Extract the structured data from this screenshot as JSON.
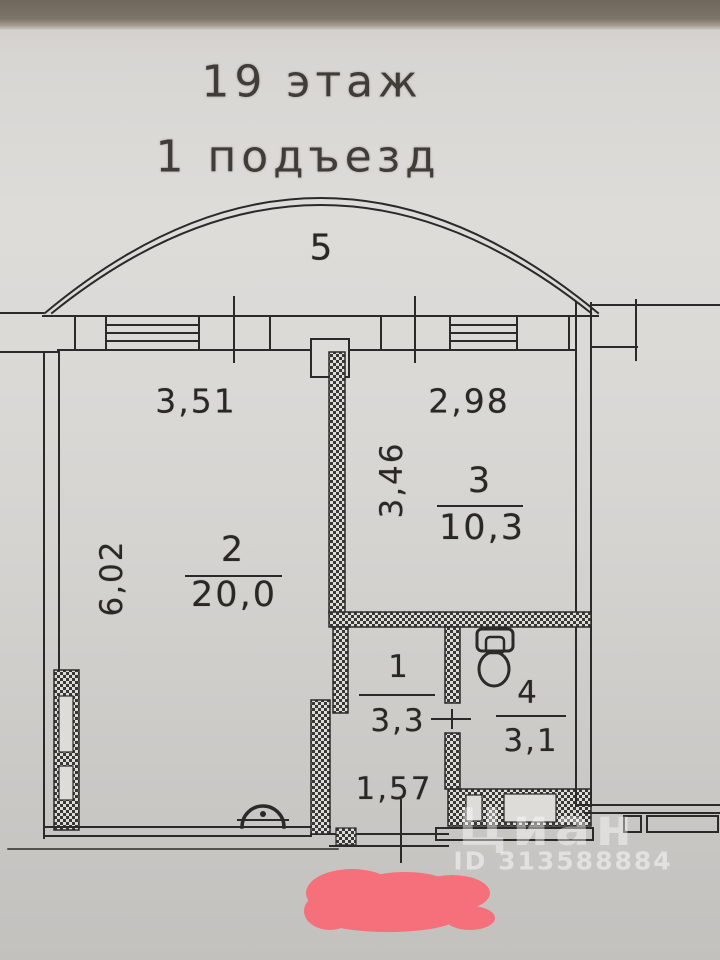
{
  "header": {
    "floor": "19 этаж",
    "entrance": "1 подъезд"
  },
  "plan": {
    "balcony_number": "5",
    "rooms": [
      {
        "number": "2",
        "area": "20,0"
      },
      {
        "number": "3",
        "area": "10,3"
      },
      {
        "number": "1",
        "area": "3,3"
      },
      {
        "number": "4",
        "area": "3,1"
      }
    ],
    "dimensions": {
      "top_left_width": "3,51",
      "top_right_width": "2,98",
      "room3_depth": "3,46",
      "room2_depth": "6,02",
      "hall_width": "1,57"
    }
  },
  "watermark": {
    "brand": "Циан",
    "id": "ID 313588884"
  },
  "colors": {
    "scribble": "#f5707a",
    "line": "#2b2a28"
  }
}
